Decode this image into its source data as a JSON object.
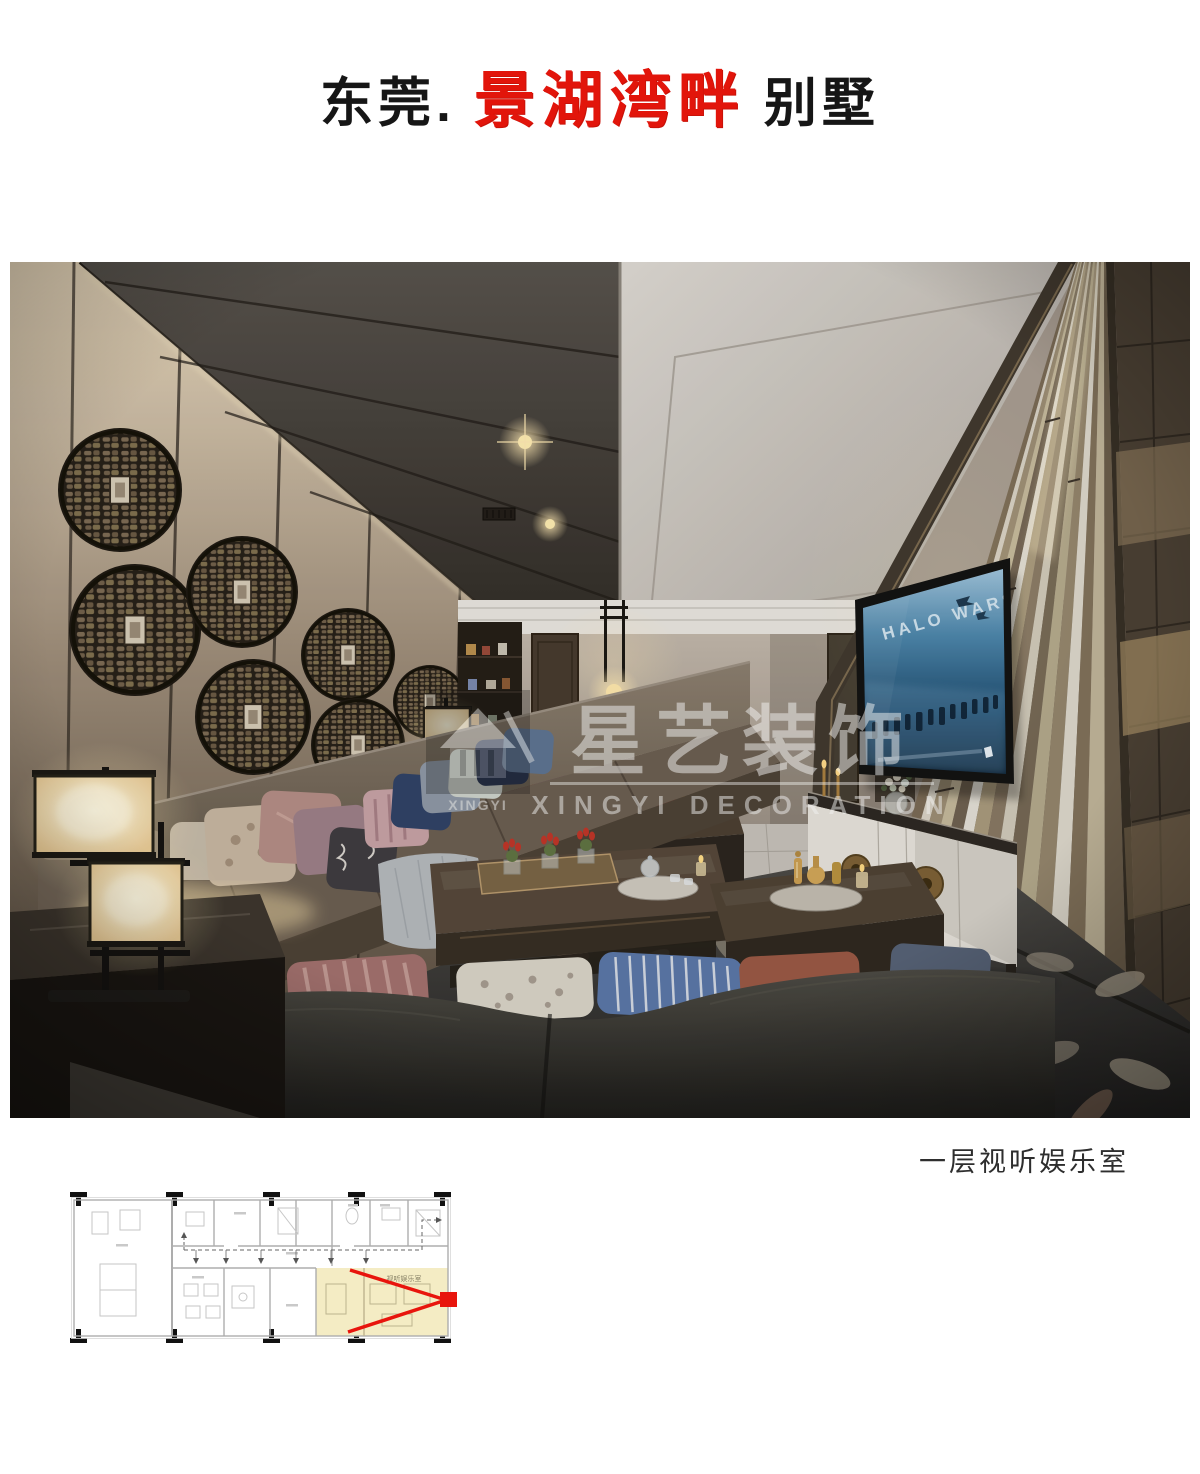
{
  "header": {
    "title_prefix": "东莞.",
    "title_highlight": "景湖湾畔",
    "title_suffix": "别墅",
    "highlight_color": "#e2150b"
  },
  "photo": {
    "caption": "一层视听娱乐室",
    "watermark": {
      "brand_cn": "星艺装饰",
      "brand_en": "XINGYI DECORATION",
      "logo_text": "XINGYI"
    },
    "tv_screen": {
      "title": "HALO WARS"
    }
  },
  "floor_plan": {
    "highlight_room_label": "视听娱乐室",
    "highlight_color": "#f4ecc4",
    "marker_color": "#e8150d"
  }
}
